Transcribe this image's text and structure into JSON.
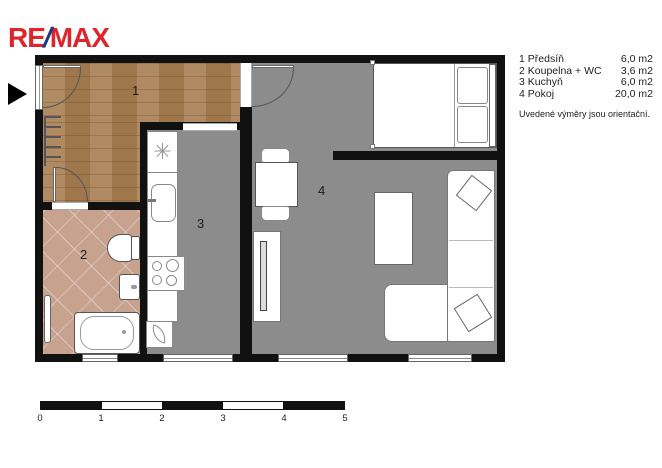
{
  "branding": {
    "logo": {
      "re": "RE",
      "slash": "/",
      "max": "MAX"
    },
    "colors": {
      "logo_red": "#dc262e",
      "logo_blue": "#1a3a80"
    }
  },
  "legend": {
    "rooms": [
      {
        "number": "1",
        "name": "Předsíň",
        "area": "6,0 m2"
      },
      {
        "number": "2",
        "name": "Koupelna + WC",
        "area": "3,6 m2"
      },
      {
        "number": "3",
        "name": "Kuchyň",
        "area": "6,0 m2"
      },
      {
        "number": "4",
        "name": "Pokoj",
        "area": "20,0 m2"
      }
    ],
    "note": "Uvedené výměry jsou orientační."
  },
  "plan": {
    "icons": {
      "fan": "✳"
    },
    "colors": {
      "wall": "#111111",
      "wood_floor": "#a87e52",
      "tile_floor": "#c7a28f",
      "hard_floor": "#8c8c8c"
    }
  },
  "scalebar": {
    "labels": [
      "0",
      "1",
      "2",
      "3",
      "4",
      "5"
    ]
  }
}
